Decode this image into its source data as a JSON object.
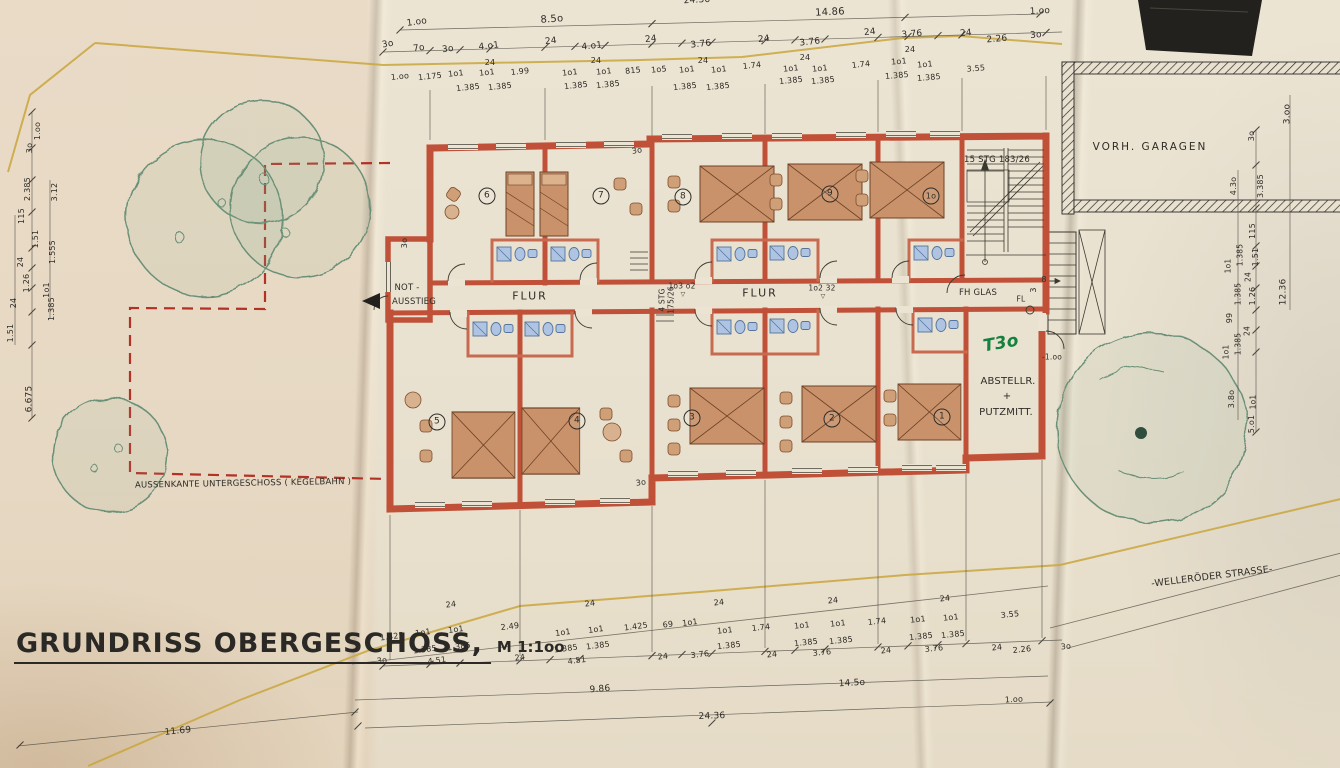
{
  "title": {
    "text": "GRUNDRISS OBERGESCHOSS,",
    "scale": "M 1:1oo"
  },
  "colors": {
    "wall": "#c05138",
    "wall_light": "#cf6a4e",
    "bed": "#c9926b",
    "bath": "#aec4e2",
    "tree": "#6a9078",
    "boundary": "#c9a63c",
    "basement_dash": "#b23226",
    "ink": "#2e2c27",
    "green_note": "#14813f"
  },
  "rooms": {
    "top": [
      "6",
      "7",
      "8",
      "9",
      "1o"
    ],
    "bottom": [
      "5",
      "4",
      "3",
      "2",
      "1"
    ]
  },
  "annotations": [
    {
      "n": "dim",
      "t": "24.36",
      "x": 697,
      "y": 1,
      "r": -3
    },
    {
      "n": "dim",
      "t": "1.oo",
      "x": 417,
      "y": 23,
      "r": -8
    },
    {
      "n": "dim",
      "t": "8.5o",
      "x": 552,
      "y": 20,
      "s": 10,
      "r": -4
    },
    {
      "n": "dim",
      "t": "14.86",
      "x": 830,
      "y": 13,
      "s": 10,
      "r": -3
    },
    {
      "n": "dim",
      "t": "1.oo",
      "x": 1040,
      "y": 12,
      "r": -3
    },
    {
      "n": "dim",
      "t": "3o",
      "x": 388,
      "y": 45,
      "r": -10
    },
    {
      "n": "dim",
      "t": "7o",
      "x": 419,
      "y": 49,
      "r": -8
    },
    {
      "n": "dim",
      "t": "3o",
      "x": 448,
      "y": 50,
      "r": -8
    },
    {
      "n": "dim",
      "t": "4.o1",
      "x": 489,
      "y": 47,
      "r": -6
    },
    {
      "n": "dim",
      "t": "24",
      "x": 551,
      "y": 42,
      "r": -6
    },
    {
      "n": "dim",
      "t": "4.o1",
      "x": 592,
      "y": 47,
      "r": -6
    },
    {
      "n": "dim",
      "t": "24",
      "x": 651,
      "y": 40,
      "r": -6
    },
    {
      "n": "dim",
      "t": "3.76",
      "x": 701,
      "y": 45,
      "r": -6
    },
    {
      "n": "dim",
      "t": "24",
      "x": 764,
      "y": 40,
      "r": -6
    },
    {
      "n": "dim",
      "t": "3.76",
      "x": 810,
      "y": 43,
      "r": -6
    },
    {
      "n": "dim",
      "t": "24",
      "x": 870,
      "y": 33,
      "r": -6
    },
    {
      "n": "dim",
      "t": "3.76",
      "x": 912,
      "y": 35,
      "r": -5
    },
    {
      "n": "dim",
      "t": "24",
      "x": 966,
      "y": 34,
      "r": -5
    },
    {
      "n": "dim",
      "t": "2.26",
      "x": 997,
      "y": 40,
      "r": -5
    },
    {
      "n": "dim",
      "t": "3o",
      "x": 1036,
      "y": 36,
      "r": -5
    },
    {
      "n": "dim",
      "t": "24",
      "x": 490,
      "y": 63,
      "s": 8
    },
    {
      "n": "dim",
      "t": "24",
      "x": 596,
      "y": 61,
      "s": 8
    },
    {
      "n": "dim",
      "t": "24",
      "x": 703,
      "y": 61,
      "s": 8
    },
    {
      "n": "dim",
      "t": "24",
      "x": 805,
      "y": 58,
      "s": 8
    },
    {
      "n": "dim",
      "t": "24",
      "x": 910,
      "y": 50,
      "s": 8
    },
    {
      "n": "dim",
      "t": "1.oo",
      "x": 400,
      "y": 77,
      "s": 8,
      "r": -6
    },
    {
      "n": "dim",
      "t": "1.175",
      "x": 430,
      "y": 77,
      "s": 8,
      "r": -6
    },
    {
      "n": "dim",
      "t": "1o1",
      "x": 456,
      "y": 74,
      "s": 8,
      "r": -6
    },
    {
      "n": "dim",
      "t": "1o1",
      "x": 487,
      "y": 73,
      "s": 8,
      "r": -6
    },
    {
      "n": "dim",
      "t": "1.99",
      "x": 520,
      "y": 72,
      "s": 8,
      "r": -6
    },
    {
      "n": "dim",
      "t": "1o1",
      "x": 570,
      "y": 73,
      "s": 8,
      "r": -6
    },
    {
      "n": "dim",
      "t": "1o1",
      "x": 604,
      "y": 72,
      "s": 8,
      "r": -6
    },
    {
      "n": "dim",
      "t": "815",
      "x": 633,
      "y": 71,
      "s": 8,
      "r": -6
    },
    {
      "n": "dim",
      "t": "1o5",
      "x": 659,
      "y": 70,
      "s": 8,
      "r": -6
    },
    {
      "n": "dim",
      "t": "1o1",
      "x": 687,
      "y": 70,
      "s": 8,
      "r": -6
    },
    {
      "n": "dim",
      "t": "1o1",
      "x": 719,
      "y": 70,
      "s": 8,
      "r": -6
    },
    {
      "n": "dim",
      "t": "1.74",
      "x": 752,
      "y": 66,
      "s": 8,
      "r": -6
    },
    {
      "n": "dim",
      "t": "1o1",
      "x": 791,
      "y": 69,
      "s": 8,
      "r": -6
    },
    {
      "n": "dim",
      "t": "1o1",
      "x": 820,
      "y": 69,
      "s": 8,
      "r": -6
    },
    {
      "n": "dim",
      "t": "1.74",
      "x": 861,
      "y": 65,
      "s": 8,
      "r": -6
    },
    {
      "n": "dim",
      "t": "1o1",
      "x": 899,
      "y": 62,
      "s": 8,
      "r": -5
    },
    {
      "n": "dim",
      "t": "1o1",
      "x": 925,
      "y": 65,
      "s": 8,
      "r": -5
    },
    {
      "n": "dim",
      "t": "3.55",
      "x": 976,
      "y": 69,
      "s": 8,
      "r": -5
    },
    {
      "n": "dim",
      "t": "1.385",
      "x": 468,
      "y": 88,
      "s": 8,
      "r": -6
    },
    {
      "n": "dim",
      "t": "1.385",
      "x": 500,
      "y": 87,
      "s": 8,
      "r": -6
    },
    {
      "n": "dim",
      "t": "1.385",
      "x": 576,
      "y": 86,
      "s": 8,
      "r": -6
    },
    {
      "n": "dim",
      "t": "1.385",
      "x": 608,
      "y": 85,
      "s": 8,
      "r": -6
    },
    {
      "n": "dim",
      "t": "1.385",
      "x": 685,
      "y": 87,
      "s": 8,
      "r": -6
    },
    {
      "n": "dim",
      "t": "1.385",
      "x": 718,
      "y": 87,
      "s": 8,
      "r": -6
    },
    {
      "n": "dim",
      "t": "1.385",
      "x": 791,
      "y": 81,
      "s": 8,
      "r": -6
    },
    {
      "n": "dim",
      "t": "1.385",
      "x": 823,
      "y": 81,
      "s": 8,
      "r": -6
    },
    {
      "n": "dim",
      "t": "1.385",
      "x": 897,
      "y": 76,
      "s": 8,
      "r": -5
    },
    {
      "n": "dim",
      "t": "1.385",
      "x": 929,
      "y": 78,
      "s": 8,
      "r": -5
    },
    {
      "n": "dim",
      "t": "24",
      "x": 451,
      "y": 605,
      "s": 8,
      "r": -7
    },
    {
      "n": "dim",
      "t": "1.425",
      "x": 392,
      "y": 637,
      "s": 8,
      "r": -7
    },
    {
      "n": "dim",
      "t": "1o1",
      "x": 423,
      "y": 633,
      "s": 8,
      "r": -7
    },
    {
      "n": "dim",
      "t": "1o1",
      "x": 456,
      "y": 630,
      "s": 8,
      "r": -7
    },
    {
      "n": "dim",
      "t": "2.49",
      "x": 510,
      "y": 627,
      "s": 8,
      "r": -7
    },
    {
      "n": "dim",
      "t": "1.385",
      "x": 425,
      "y": 650,
      "s": 8,
      "r": -7
    },
    {
      "n": "dim",
      "t": "1.385",
      "x": 459,
      "y": 647,
      "s": 8,
      "r": -7
    },
    {
      "n": "dim",
      "t": "3o",
      "x": 382,
      "y": 661,
      "s": 8,
      "r": -7
    },
    {
      "n": "dim",
      "t": "4.51",
      "x": 437,
      "y": 661,
      "s": 8,
      "r": -7
    },
    {
      "n": "dim",
      "t": "24",
      "x": 520,
      "y": 658,
      "s": 8,
      "r": -7
    },
    {
      "n": "dim",
      "t": "24",
      "x": 590,
      "y": 604,
      "s": 8,
      "r": -7
    },
    {
      "n": "dim",
      "t": "1o1",
      "x": 563,
      "y": 633,
      "s": 8,
      "r": -7
    },
    {
      "n": "dim",
      "t": "1o1",
      "x": 596,
      "y": 630,
      "s": 8,
      "r": -7
    },
    {
      "n": "dim",
      "t": "1.425",
      "x": 636,
      "y": 627,
      "s": 8,
      "r": -7
    },
    {
      "n": "dim",
      "t": "69",
      "x": 668,
      "y": 625,
      "s": 8,
      "r": -7
    },
    {
      "n": "dim",
      "t": "1o1",
      "x": 690,
      "y": 623,
      "s": 8,
      "r": -7
    },
    {
      "n": "dim",
      "t": "1.385",
      "x": 566,
      "y": 649,
      "s": 8,
      "r": -7
    },
    {
      "n": "dim",
      "t": "1.385",
      "x": 598,
      "y": 646,
      "s": 8,
      "r": -7
    },
    {
      "n": "dim",
      "t": "4.51",
      "x": 577,
      "y": 661,
      "s": 8,
      "r": -7
    },
    {
      "n": "dim",
      "t": "24",
      "x": 663,
      "y": 657,
      "s": 8,
      "r": -7
    },
    {
      "n": "dim",
      "t": "3.76",
      "x": 700,
      "y": 655,
      "s": 8,
      "r": -7
    },
    {
      "n": "dim",
      "t": "24",
      "x": 719,
      "y": 603,
      "s": 8,
      "r": -6
    },
    {
      "n": "dim",
      "t": "1o1",
      "x": 725,
      "y": 631,
      "s": 8,
      "r": -6
    },
    {
      "n": "dim",
      "t": "1.74",
      "x": 761,
      "y": 628,
      "s": 8,
      "r": -6
    },
    {
      "n": "dim",
      "t": "1o1",
      "x": 802,
      "y": 626,
      "s": 8,
      "r": -6
    },
    {
      "n": "dim",
      "t": "24",
      "x": 833,
      "y": 601,
      "s": 8,
      "r": -6
    },
    {
      "n": "dim",
      "t": "1o1",
      "x": 838,
      "y": 624,
      "s": 8,
      "r": -6
    },
    {
      "n": "dim",
      "t": "1.74",
      "x": 877,
      "y": 622,
      "s": 8,
      "r": -6
    },
    {
      "n": "dim",
      "t": "1o1",
      "x": 918,
      "y": 620,
      "s": 8,
      "r": -6
    },
    {
      "n": "dim",
      "t": "1o1",
      "x": 951,
      "y": 618,
      "s": 8,
      "r": -6
    },
    {
      "n": "dim",
      "t": "24",
      "x": 945,
      "y": 599,
      "s": 8,
      "r": -6
    },
    {
      "n": "dim",
      "t": "3.55",
      "x": 1010,
      "y": 615,
      "s": 8,
      "r": -6
    },
    {
      "n": "dim",
      "t": "1.385",
      "x": 729,
      "y": 646,
      "s": 8,
      "r": -6
    },
    {
      "n": "dim",
      "t": "1.385",
      "x": 806,
      "y": 643,
      "s": 8,
      "r": -6
    },
    {
      "n": "dim",
      "t": "1.385",
      "x": 841,
      "y": 641,
      "s": 8,
      "r": -6
    },
    {
      "n": "dim",
      "t": "1.385",
      "x": 921,
      "y": 637,
      "s": 8,
      "r": -6
    },
    {
      "n": "dim",
      "t": "1.385",
      "x": 953,
      "y": 635,
      "s": 8,
      "r": -6
    },
    {
      "n": "dim",
      "t": "24",
      "x": 772,
      "y": 655,
      "s": 8,
      "r": -6
    },
    {
      "n": "dim",
      "t": "3.76",
      "x": 822,
      "y": 653,
      "s": 8,
      "r": -6
    },
    {
      "n": "dim",
      "t": "24",
      "x": 886,
      "y": 651,
      "s": 8,
      "r": -6
    },
    {
      "n": "dim",
      "t": "3.76",
      "x": 934,
      "y": 649,
      "s": 8,
      "r": -6
    },
    {
      "n": "dim",
      "t": "24",
      "x": 997,
      "y": 648,
      "s": 8,
      "r": -6
    },
    {
      "n": "dim",
      "t": "2.26",
      "x": 1022,
      "y": 650,
      "s": 8,
      "r": -6
    },
    {
      "n": "dim",
      "t": "3o",
      "x": 1066,
      "y": 647,
      "s": 8,
      "r": -6
    },
    {
      "n": "dim",
      "t": "9.86",
      "x": 600,
      "y": 690,
      "s": 9,
      "r": -4
    },
    {
      "n": "dim",
      "t": "14.5o",
      "x": 852,
      "y": 684,
      "s": 9,
      "r": -3
    },
    {
      "n": "dim",
      "t": "24.36",
      "x": 712,
      "y": 717,
      "s": 9,
      "r": -2
    },
    {
      "n": "dim",
      "t": "1.oo",
      "x": 1014,
      "y": 700,
      "s": 8,
      "r": -3
    },
    {
      "n": "dim",
      "t": "11.69",
      "x": 178,
      "y": 732,
      "s": 9,
      "r": -6
    },
    {
      "n": "dim",
      "t": "1.oo",
      "x": 38,
      "y": 131,
      "s": 8,
      "r": -90
    },
    {
      "n": "dim",
      "t": "3o",
      "x": 30,
      "y": 148,
      "s": 8,
      "r": -90
    },
    {
      "n": "dim",
      "t": "2.385",
      "x": 28,
      "y": 189,
      "s": 8,
      "r": -90
    },
    {
      "n": "dim",
      "t": "3.12",
      "x": 55,
      "y": 192,
      "s": 8,
      "r": -90
    },
    {
      "n": "dim",
      "t": "115",
      "x": 22,
      "y": 216,
      "s": 8,
      "r": -90
    },
    {
      "n": "dim",
      "t": "1.51",
      "x": 36,
      "y": 239,
      "s": 8,
      "r": -90
    },
    {
      "n": "dim",
      "t": "24",
      "x": 21,
      "y": 262,
      "s": 8,
      "r": -90
    },
    {
      "n": "dim",
      "t": "1.26",
      "x": 27,
      "y": 283,
      "s": 8,
      "r": -90
    },
    {
      "n": "dim",
      "t": "24",
      "x": 14,
      "y": 303,
      "s": 8,
      "r": -90
    },
    {
      "n": "dim",
      "t": "1.51",
      "x": 11,
      "y": 333,
      "s": 8,
      "r": -90
    },
    {
      "n": "dim",
      "t": "1.555",
      "x": 53,
      "y": 252,
      "s": 8,
      "r": -90
    },
    {
      "n": "dim",
      "t": "1o1",
      "x": 47,
      "y": 290,
      "s": 8,
      "r": -90
    },
    {
      "n": "dim",
      "t": "1.385",
      "x": 52,
      "y": 309,
      "s": 8,
      "r": -90
    },
    {
      "n": "dim",
      "t": "6.675",
      "x": 30,
      "y": 399,
      "s": 9,
      "r": -90
    },
    {
      "n": "dim",
      "t": "3.oo",
      "x": 1288,
      "y": 114,
      "s": 9,
      "r": -90
    },
    {
      "n": "dim",
      "t": "3o",
      "x": 1252,
      "y": 136,
      "s": 8,
      "r": -90
    },
    {
      "n": "dim",
      "t": "4.3o",
      "x": 1234,
      "y": 186,
      "s": 8,
      "r": -90
    },
    {
      "n": "dim",
      "t": "3.385",
      "x": 1261,
      "y": 186,
      "s": 8,
      "r": -90
    },
    {
      "n": "dim",
      "t": "115",
      "x": 1253,
      "y": 231,
      "s": 8,
      "r": -90
    },
    {
      "n": "dim",
      "t": "1.385",
      "x": 1240,
      "y": 255,
      "s": 7.5,
      "r": -90
    },
    {
      "n": "dim",
      "t": "1.51",
      "x": 1256,
      "y": 257,
      "s": 8,
      "r": -90
    },
    {
      "n": "dim",
      "t": "1o1",
      "x": 1228,
      "y": 266,
      "s": 7.5,
      "r": -90
    },
    {
      "n": "dim",
      "t": "24",
      "x": 1248,
      "y": 277,
      "s": 7.5,
      "r": -90
    },
    {
      "n": "dim",
      "t": "1.385",
      "x": 1238,
      "y": 294,
      "s": 7.5,
      "r": -90
    },
    {
      "n": "dim",
      "t": "1.26",
      "x": 1253,
      "y": 296,
      "s": 8,
      "r": -90
    },
    {
      "n": "dim",
      "t": "99",
      "x": 1230,
      "y": 318,
      "s": 8,
      "r": -90
    },
    {
      "n": "dim",
      "t": "24",
      "x": 1247,
      "y": 331,
      "s": 7.5,
      "r": -90
    },
    {
      "n": "dim",
      "t": "1.385",
      "x": 1238,
      "y": 344,
      "s": 7.5,
      "r": -90
    },
    {
      "n": "dim",
      "t": "1o1",
      "x": 1226,
      "y": 352,
      "s": 7.5,
      "r": -90
    },
    {
      "n": "dim",
      "t": "12.36",
      "x": 1284,
      "y": 292,
      "s": 9,
      "r": -90
    },
    {
      "n": "dim",
      "t": "3.8o",
      "x": 1232,
      "y": 399,
      "s": 8,
      "r": -90
    },
    {
      "n": "dim",
      "t": "1o1",
      "x": 1253,
      "y": 402,
      "s": 7.5,
      "r": -90
    },
    {
      "n": "dim",
      "t": "5.o1",
      "x": 1252,
      "y": 424,
      "s": 8,
      "r": -90
    },
    {
      "n": "label-not-ausstieg-1",
      "t": "NOT -",
      "x": 407,
      "y": 288,
      "s": 8.5
    },
    {
      "n": "label-not-ausstieg-2",
      "t": "AUSSTIEG",
      "x": 414,
      "y": 302,
      "s": 8.5
    },
    {
      "n": "label-flur-left",
      "t": "FLUR",
      "x": 530,
      "y": 296,
      "s": 11,
      "c": "sp"
    },
    {
      "n": "label-flur-right",
      "t": "FLUR",
      "x": 760,
      "y": 293,
      "s": 11,
      "c": "sp"
    },
    {
      "n": "level-mark-left",
      "t": "1o3 o2",
      "x": 682,
      "y": 286,
      "s": 7.5
    },
    {
      "n": "level-mark-left-tri",
      "t": "▽",
      "x": 683,
      "y": 295,
      "s": 6
    },
    {
      "n": "level-mark-right",
      "t": "1o2 32",
      "x": 822,
      "y": 288,
      "s": 7.5
    },
    {
      "n": "level-mark-right-tri",
      "t": "▽",
      "x": 823,
      "y": 297,
      "s": 6
    },
    {
      "n": "label-stair-4stg",
      "t": "4 STG",
      "x": 662,
      "y": 300,
      "s": 7.5,
      "r": -90
    },
    {
      "n": "label-stair-4stg-2",
      "t": "175/26",
      "x": 671,
      "y": 300,
      "s": 7.5,
      "r": -90
    },
    {
      "n": "label-stair-15stg",
      "t": "15 STG 183/26",
      "x": 997,
      "y": 160,
      "s": 8.5
    },
    {
      "n": "label-fh-glas",
      "t": "FH GLAS",
      "x": 978,
      "y": 293,
      "s": 8.5
    },
    {
      "n": "label-fl",
      "t": "FL",
      "x": 1021,
      "y": 299,
      "s": 7.5
    },
    {
      "n": "dim",
      "t": "8",
      "x": 1044,
      "y": 280,
      "s": 8
    },
    {
      "n": "dim",
      "t": "3",
      "x": 1034,
      "y": 290,
      "s": 8,
      "r": -90
    },
    {
      "n": "note-t30-green",
      "t": "T3o",
      "x": 1001,
      "y": 344,
      "s": 17,
      "r": -10,
      "c": "g"
    },
    {
      "n": "label-abstellraum-1",
      "t": "ABSTELLR.",
      "x": 1008,
      "y": 382,
      "s": 10
    },
    {
      "n": "label-abstellraum-2",
      "t": "+",
      "x": 1007,
      "y": 397,
      "s": 10
    },
    {
      "n": "label-abstellraum-3",
      "t": "PUTZMITT.",
      "x": 1006,
      "y": 413,
      "s": 10
    },
    {
      "n": "level-mark-minus100",
      "t": "-1.oo",
      "x": 1052,
      "y": 357,
      "s": 7.5
    },
    {
      "n": "dim",
      "t": "3o",
      "x": 405,
      "y": 243,
      "s": 8,
      "r": -90
    },
    {
      "n": "dim",
      "t": "3o",
      "x": 637,
      "y": 151,
      "s": 8,
      "r": -10
    },
    {
      "n": "dim",
      "t": "3o",
      "x": 641,
      "y": 483,
      "s": 8,
      "r": -8
    },
    {
      "n": "label-vorh-garagen",
      "t": "VORH. GARAGEN",
      "x": 1150,
      "y": 147,
      "s": 10.5,
      "c": "sp"
    },
    {
      "n": "label-strasse",
      "t": "-WELLERÖDER STRASSE-",
      "x": 1212,
      "y": 577,
      "s": 9.5,
      "r": -7
    },
    {
      "n": "label-aussenkante",
      "t": "AUSSENKANTE  UNTERGESCHOSS ( KEGELBAHN )",
      "x": 243,
      "y": 484,
      "s": 8.5,
      "r": -1
    },
    {
      "n": "room-number-6",
      "t": "6",
      "x": 487,
      "y": 196,
      "s": 9,
      "c": "circ"
    },
    {
      "n": "room-number-7",
      "t": "7",
      "x": 601,
      "y": 196,
      "s": 9,
      "c": "circ"
    },
    {
      "n": "room-number-8",
      "t": "8",
      "x": 683,
      "y": 197,
      "s": 9,
      "c": "circ"
    },
    {
      "n": "room-number-9",
      "t": "9",
      "x": 830,
      "y": 194,
      "s": 9,
      "c": "circ"
    },
    {
      "n": "room-number-10",
      "t": "1o",
      "x": 931,
      "y": 196,
      "s": 8,
      "c": "circ"
    },
    {
      "n": "room-number-5",
      "t": "5",
      "x": 437,
      "y": 422,
      "s": 9,
      "c": "circ"
    },
    {
      "n": "room-number-4",
      "t": "4",
      "x": 577,
      "y": 421,
      "s": 9,
      "c": "circ"
    },
    {
      "n": "room-number-3",
      "t": "3",
      "x": 692,
      "y": 418,
      "s": 9,
      "c": "circ"
    },
    {
      "n": "room-number-2",
      "t": "2",
      "x": 832,
      "y": 419,
      "s": 9,
      "c": "circ"
    },
    {
      "n": "room-number-1",
      "t": "1",
      "x": 942,
      "y": 417,
      "s": 9,
      "c": "circ"
    }
  ]
}
